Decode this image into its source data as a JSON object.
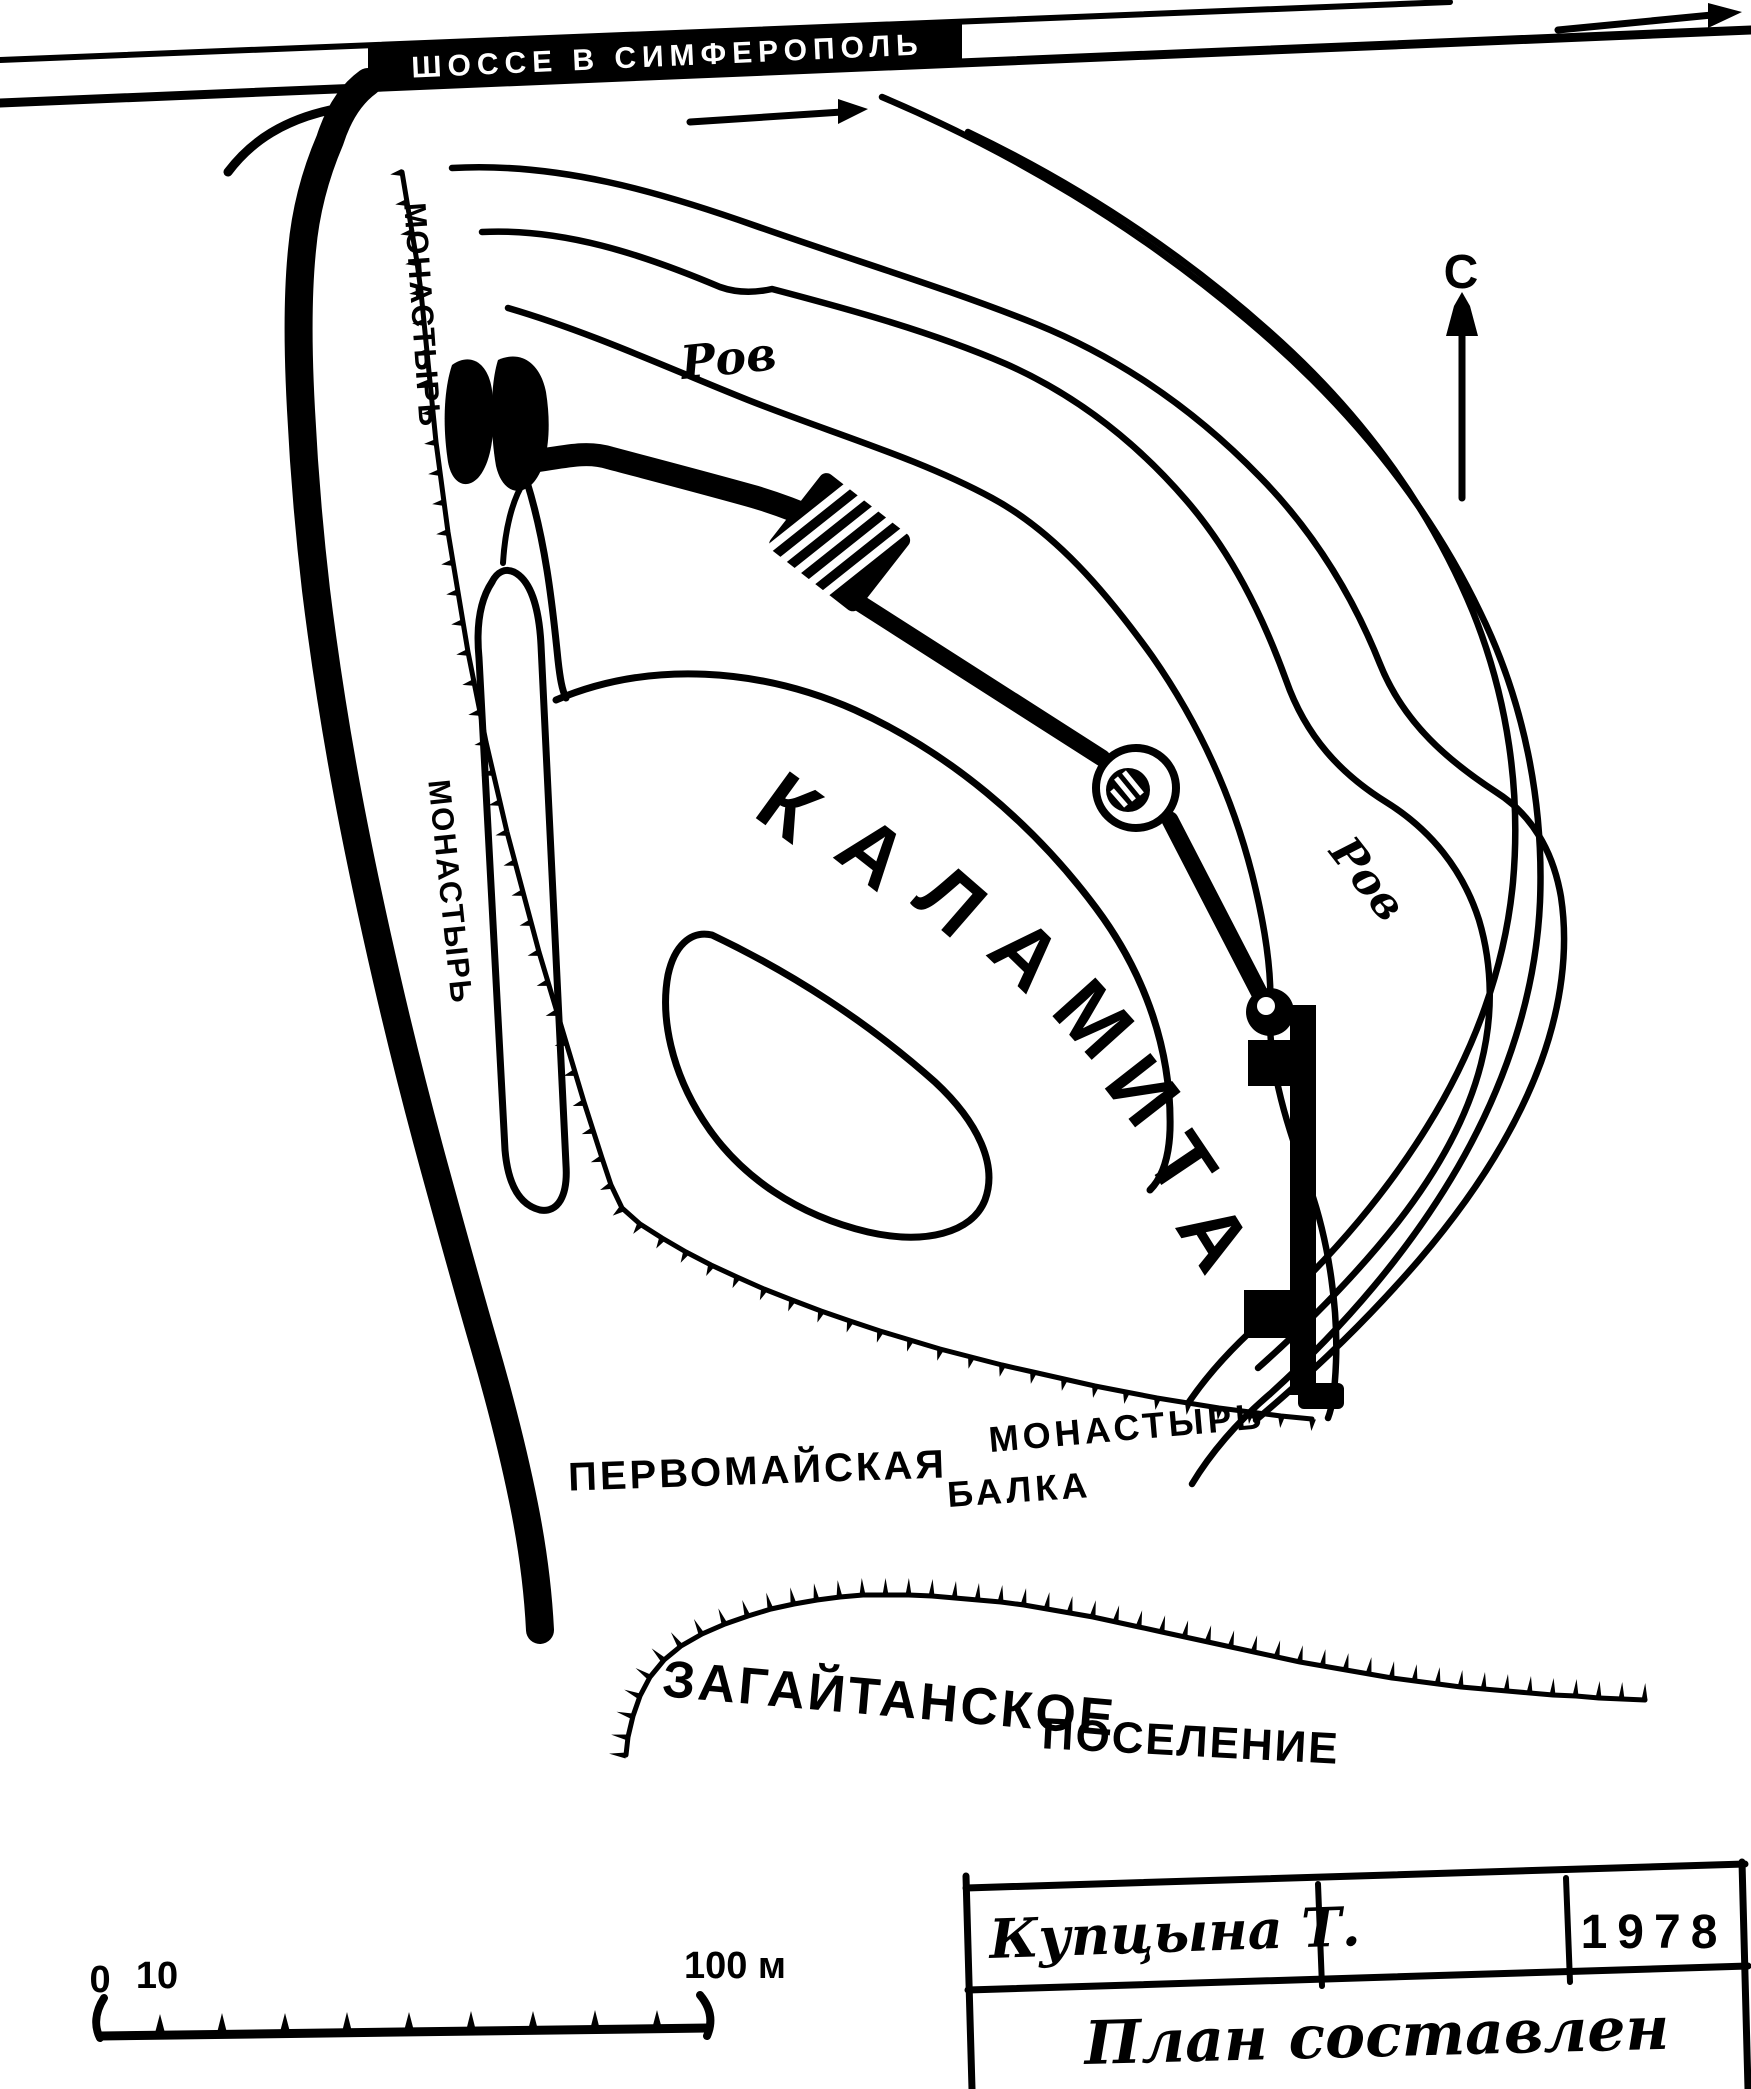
{
  "map_title": "КАЛАМИТА",
  "colors": {
    "ink": "#000000",
    "paper": "#ffffff"
  },
  "labels": {
    "highway": {
      "text": "ШОССЕ В СИМФЕРОПОЛЬ"
    },
    "monastery_top": {
      "text": "МОНАСТЫРЬ"
    },
    "monastery_mid": {
      "text": "МОНАСТЫРЬ"
    },
    "monastery_south": {
      "text": "МОНАСТЫРЬ"
    },
    "moat_north": {
      "text": "Ров"
    },
    "moat_east": {
      "text": "Ров"
    },
    "ravine_word1": {
      "text": "ПЕРВОМАЙСКАЯ"
    },
    "ravine_word2": {
      "text": "БАЛКА"
    },
    "settlement_word1": {
      "text": "ЗАГАЙТАНСКОЕ"
    },
    "settlement_word2": {
      "text": "ПОСЕЛЕНИЕ"
    },
    "north": {
      "text": "С"
    }
  },
  "fortress_name": {
    "text": "КАЛАМИТА",
    "letters": [
      "К",
      "А",
      "Л",
      "А",
      "М",
      "И",
      "Т",
      "А"
    ]
  },
  "scale_bar": {
    "tick0": "0",
    "tick10": "10",
    "tick100": "100 м"
  },
  "title_block": {
    "author": "Купцына Т.",
    "year": "1978",
    "caption": "План составлен"
  },
  "icons": {
    "north_arrow": "arrow-up",
    "highway_arrows": "arrow-right"
  }
}
